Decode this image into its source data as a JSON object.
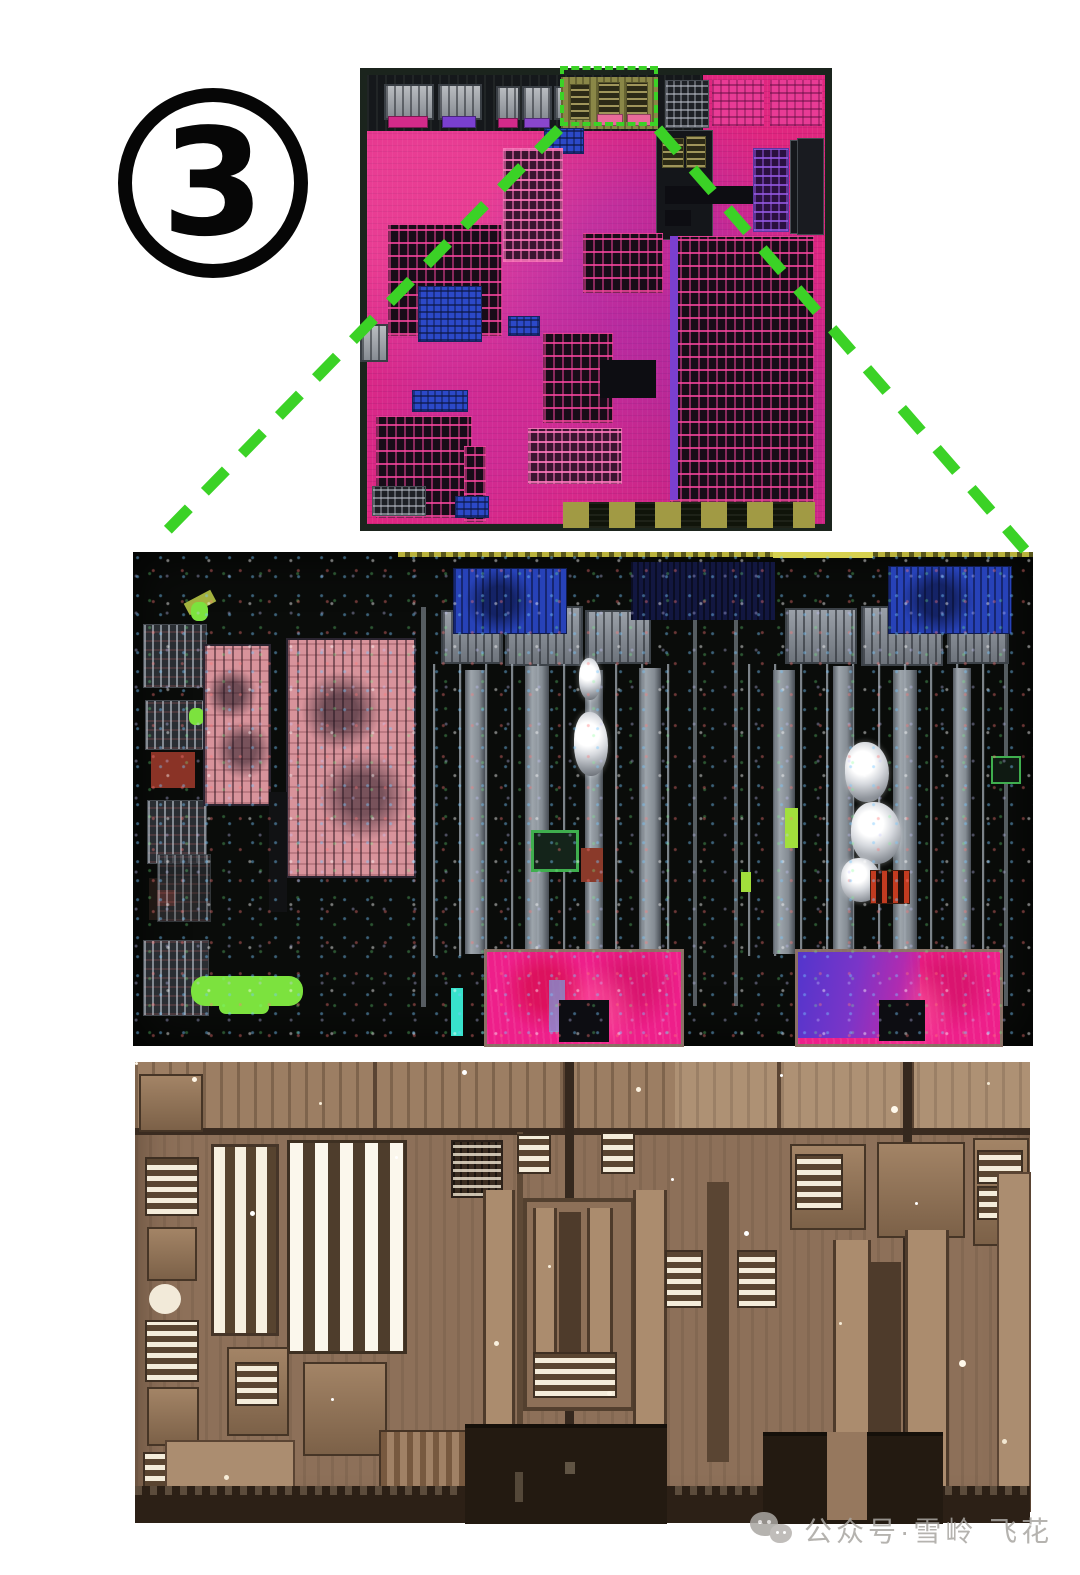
{
  "page": {
    "width": 1080,
    "height": 1575,
    "background": "#ffffff"
  },
  "annotation": {
    "number": "3"
  },
  "panels": {
    "overview": "chip-die-overview-photo",
    "detail_mid": "die-region-closeup-photo",
    "detail_high": "die-region-high-magnification-photo"
  },
  "watermark": {
    "icon": "wechat-logo",
    "text": "公众号·雪岭 飞花"
  },
  "colors": {
    "page_bg": "#ffffff",
    "highlight_green": "#3bd226",
    "die_magenta": "#e0267f",
    "die_border": "#1b241d",
    "detail_bg": "#0a0c0a",
    "macro_pink": "#ee1f8a",
    "macro_purple": "#5335cc",
    "sepia_base": "#8d7059",
    "sepia_light": "#b6977b",
    "sepia_dark": "#2c2016",
    "watermark_gray": "#a9a6a2"
  }
}
